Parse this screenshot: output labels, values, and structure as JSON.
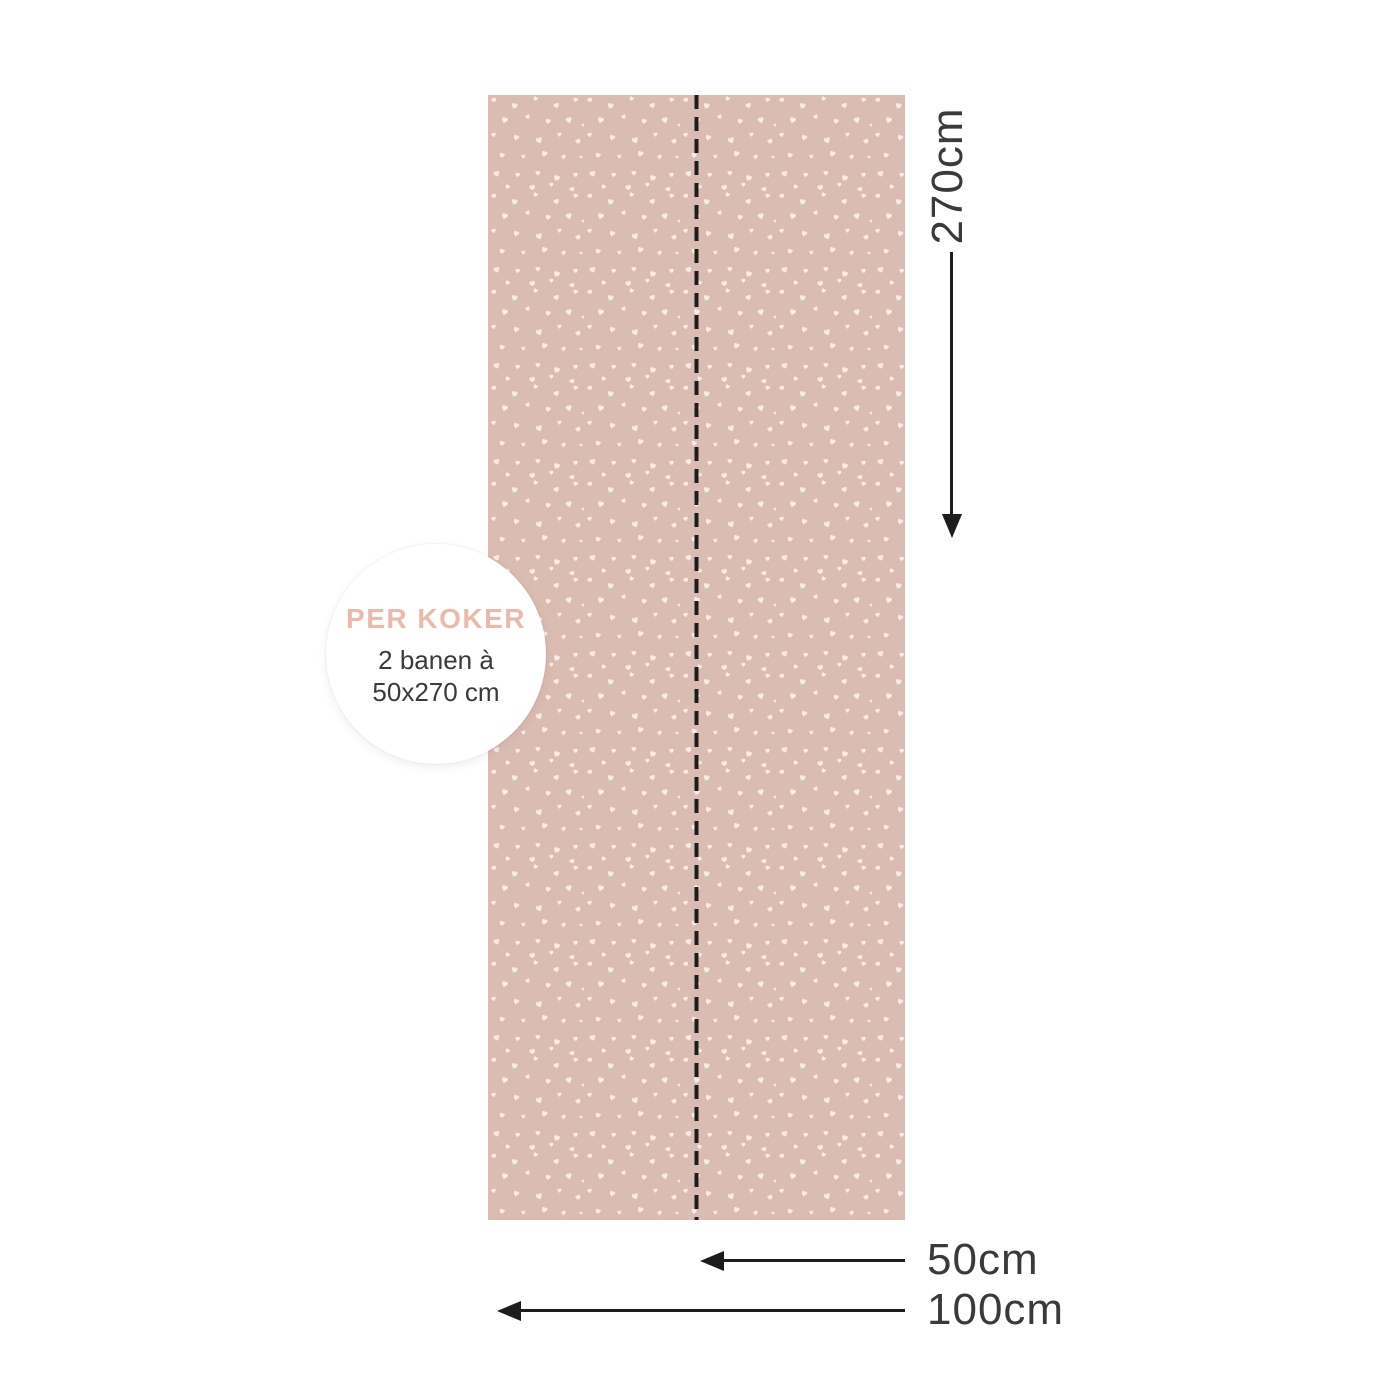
{
  "badge": {
    "title": "PER KOKER",
    "line1": "2 banen à",
    "line2": "50x270 cm"
  },
  "dimensions": {
    "height": "270cm",
    "half_width": "50cm",
    "full_width": "100cm"
  },
  "pattern": {
    "motif": "scattered white hearts",
    "strips_per_roll": 2
  },
  "colors": {
    "background": "#ffffff",
    "panel_pink": "#dbbcb3",
    "heart_cream": "#f7ebe6",
    "line_black": "#1d1d1b",
    "text_dark": "#3a3a38",
    "badge_title_pink": "#ecbaad"
  }
}
